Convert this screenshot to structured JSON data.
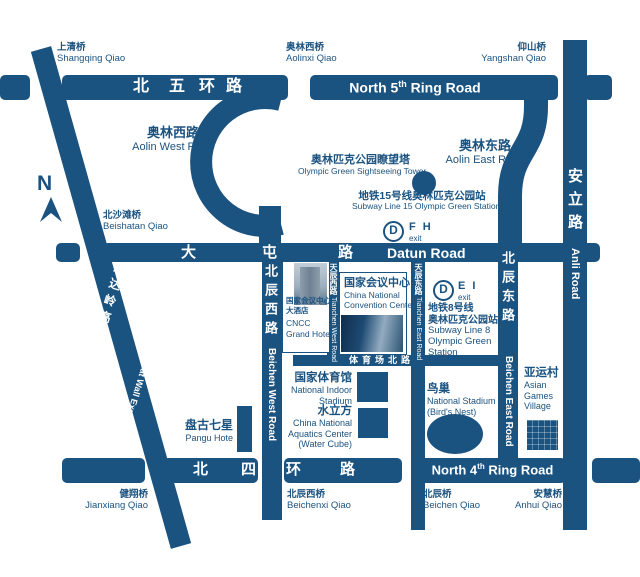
{
  "compass": {
    "label": "N"
  },
  "bridges": {
    "shangqing": {
      "zh": "上清桥",
      "en": "Shangqing Qiao"
    },
    "aolinxi": {
      "zh": "奥林西桥",
      "en": "Aolinxi Qiao"
    },
    "yangshan": {
      "zh": "仰山桥",
      "en": "Yangshan Qiao"
    },
    "beishatan": {
      "zh": "北沙滩桥",
      "en": "Beishatan Qiao"
    },
    "jianxiang": {
      "zh": "健翔桥",
      "en": "Jianxiang Qiao"
    },
    "beichenxi": {
      "zh": "北辰西桥",
      "en": "Beichenxi Qiao"
    },
    "beichen": {
      "zh": "北辰桥",
      "en": "Beichen Qiao"
    },
    "anhui": {
      "zh": "安慧桥",
      "en": "Anhui Qiao"
    }
  },
  "roads": {
    "ring5": {
      "zh": [
        "北",
        "五",
        "环",
        "路"
      ],
      "en_pre": "North 5",
      "en_sup": "th",
      "en_post": " Ring Road"
    },
    "ring4": {
      "zh": [
        "北",
        "四",
        "环",
        "路"
      ],
      "en_pre": "North 4",
      "en_sup": "th",
      "en_post": " Ring Road"
    },
    "datun": {
      "zh": [
        "大",
        "屯",
        "路"
      ],
      "en": "Datun Road"
    },
    "anli": {
      "zh": "安立路",
      "en": "Anli Road"
    },
    "aolin_west": {
      "zh": "奥林西路",
      "en": "Aolin West Road"
    },
    "aolin_east": {
      "zh": "奥林东路",
      "en": "Aolin East Road"
    },
    "beichen_west": {
      "zh": "北辰西路",
      "en": "Beichen West Road"
    },
    "beichen_east": {
      "zh": "北辰东路",
      "en": "Beichen East Road"
    },
    "tianchen_west": {
      "zh": "天辰西路",
      "en": "Tianchen West Road"
    },
    "tianchen_east": {
      "zh": "天辰东路",
      "en": "Tianchen East Road"
    },
    "badaling": {
      "zh": "八达岭高速",
      "en": "Great Wall Expressway"
    },
    "tiyuchang": {
      "zh": "体育场北路"
    }
  },
  "stations": {
    "logo_letter": "D",
    "line15": {
      "zh": "地铁15号线奥林匹克公园站",
      "en": "Subway Line 15 Olympic Green Station",
      "exit_code": "F H",
      "exit_label": "exit"
    },
    "line8": {
      "zh_line": "地铁8号线",
      "zh_station": "奥林匹克公园站",
      "en1": "Subway Line 8",
      "en2": "Olympic Green",
      "en3": "Station",
      "exit_code": "E I",
      "exit_label": "exit"
    }
  },
  "pois": {
    "tower": {
      "zh": "奥林匹克公园瞭望塔",
      "en": "Olympic Green Sightseeing Tower"
    },
    "cncc": {
      "zh": "国家会议中心",
      "en1": "China National",
      "en2": "Convention Center"
    },
    "cncc_hotel": {
      "zh1": "国家会议中心",
      "zh2": "大酒店",
      "en1": "CNCC",
      "en2": "Grand Hotel"
    },
    "indoor_stadium": {
      "zh": "国家体育馆",
      "en1": "National Indoor",
      "en2": "Stadium"
    },
    "water_cube": {
      "zh": "水立方",
      "en1": "China National",
      "en2": "Aquatics Center",
      "en3": "(Water Cube)"
    },
    "birds_nest": {
      "zh": "鸟巢",
      "en1": "National Stadium",
      "en2": "(Bird's Nest)"
    },
    "asian_games": {
      "zh": "亚运村",
      "en1": "Asian",
      "en2": "Games",
      "en3": "Village"
    },
    "pangu": {
      "zh": "盘古七星",
      "en": "Pangu Hote"
    }
  },
  "colors": {
    "road_blue": "#1a5280"
  }
}
